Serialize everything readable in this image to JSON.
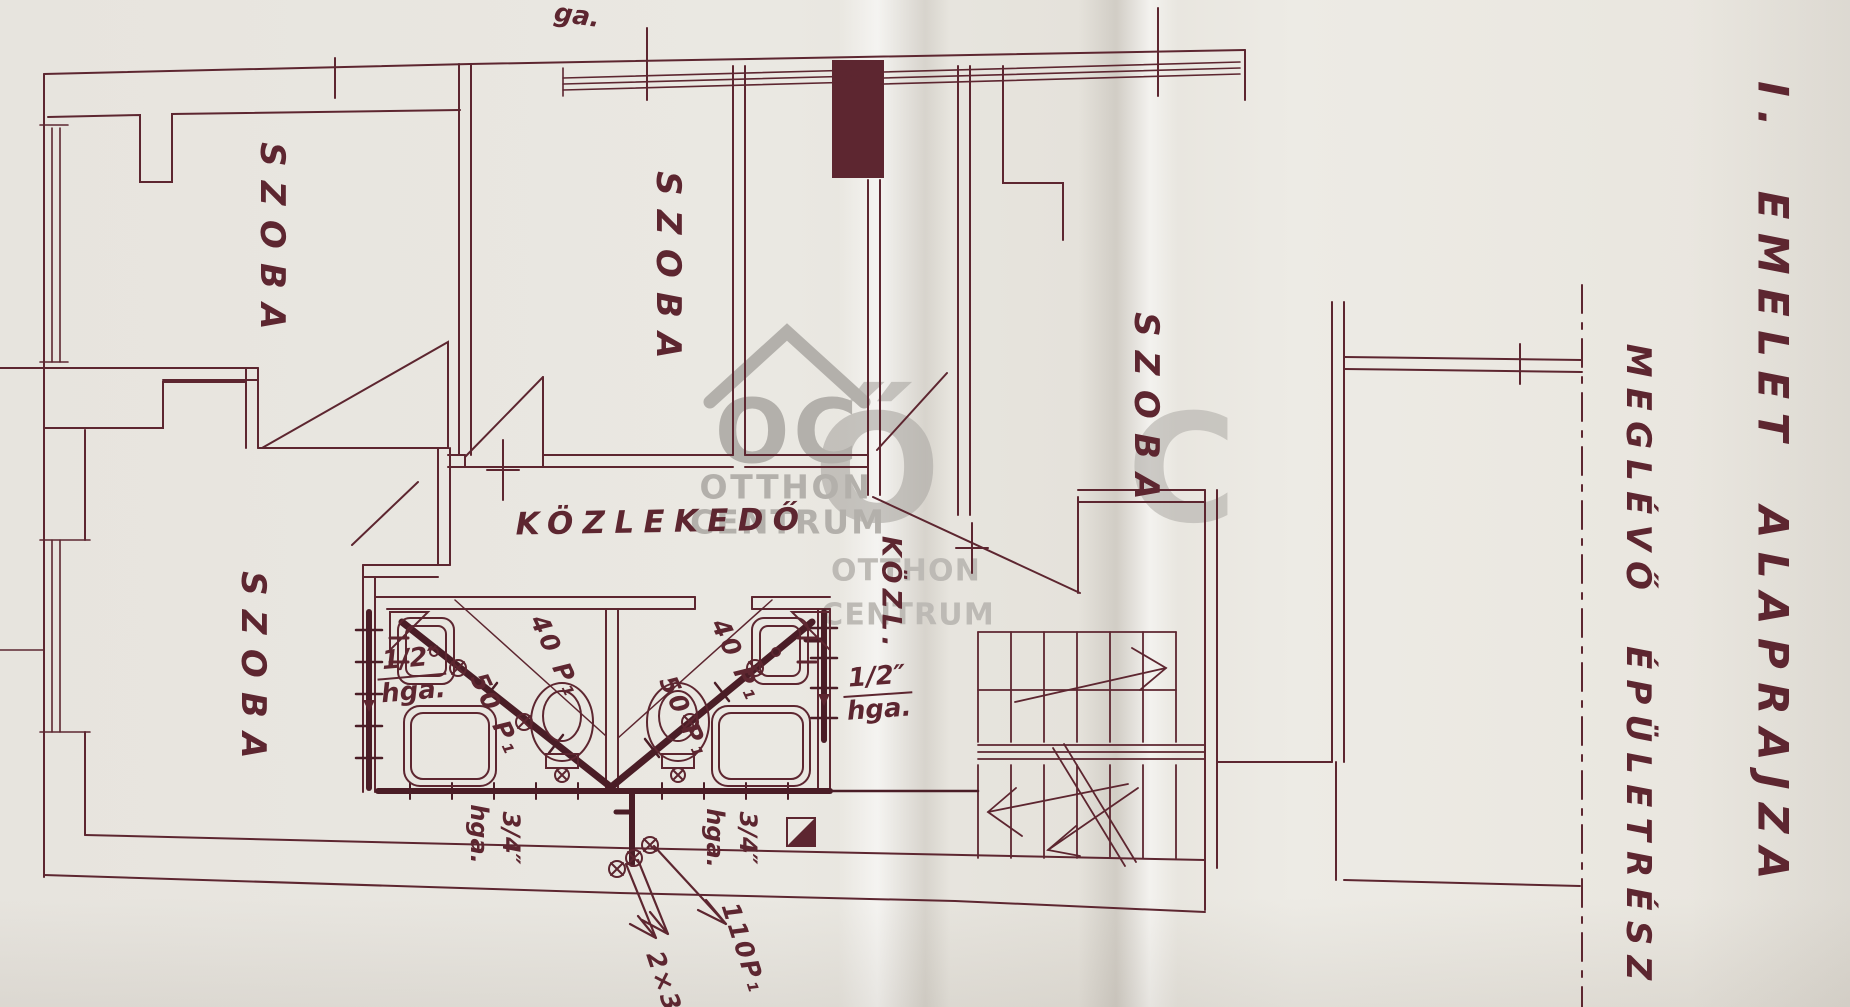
{
  "titles": {
    "main": "I. EMELET ALAPRAJZA",
    "annex": "MEGLÉVŐ ÉPÜLETRÉSZ"
  },
  "rooms": {
    "room_top_left": "SZOBA",
    "room_top_middle": "SZOBA",
    "room_right": "SZOBA",
    "room_bottom_left": "SZOBA",
    "corridor": "KÖZLEKEDŐ",
    "corridor_abbrev": "KÖZL."
  },
  "annotations": {
    "left_dim_size": "1/2″",
    "left_dim_unit": "hga.",
    "right_dim_size": "1/2″",
    "right_dim_unit": "hga.",
    "left_drop_unit": "hga.",
    "left_drop_size": "3/4″",
    "right_drop_unit": "hga.",
    "right_drop_size": "3/4″",
    "cell1_pipe_upper": "40 P₁",
    "cell1_pipe_lower": "50 P₁",
    "cell2_pipe_upper": "40 P₁",
    "cell2_pipe_lower": "50 P₁",
    "drain_label": "110P₁",
    "branch_label": "2×3",
    "top_edge_partial": "ga."
  },
  "watermark": {
    "initials": "OC",
    "line1": "OTTHON",
    "line2": "CENTRUM",
    "large_o": "Ő",
    "large_c": "C",
    "second_line1": "OTTHON",
    "second_line2": "CENTRUM"
  },
  "colors": {
    "ink": "#5d2630",
    "pipe": "#4a1d26",
    "paper": "#e9e7e1",
    "watermark": "#b3b0ab"
  }
}
